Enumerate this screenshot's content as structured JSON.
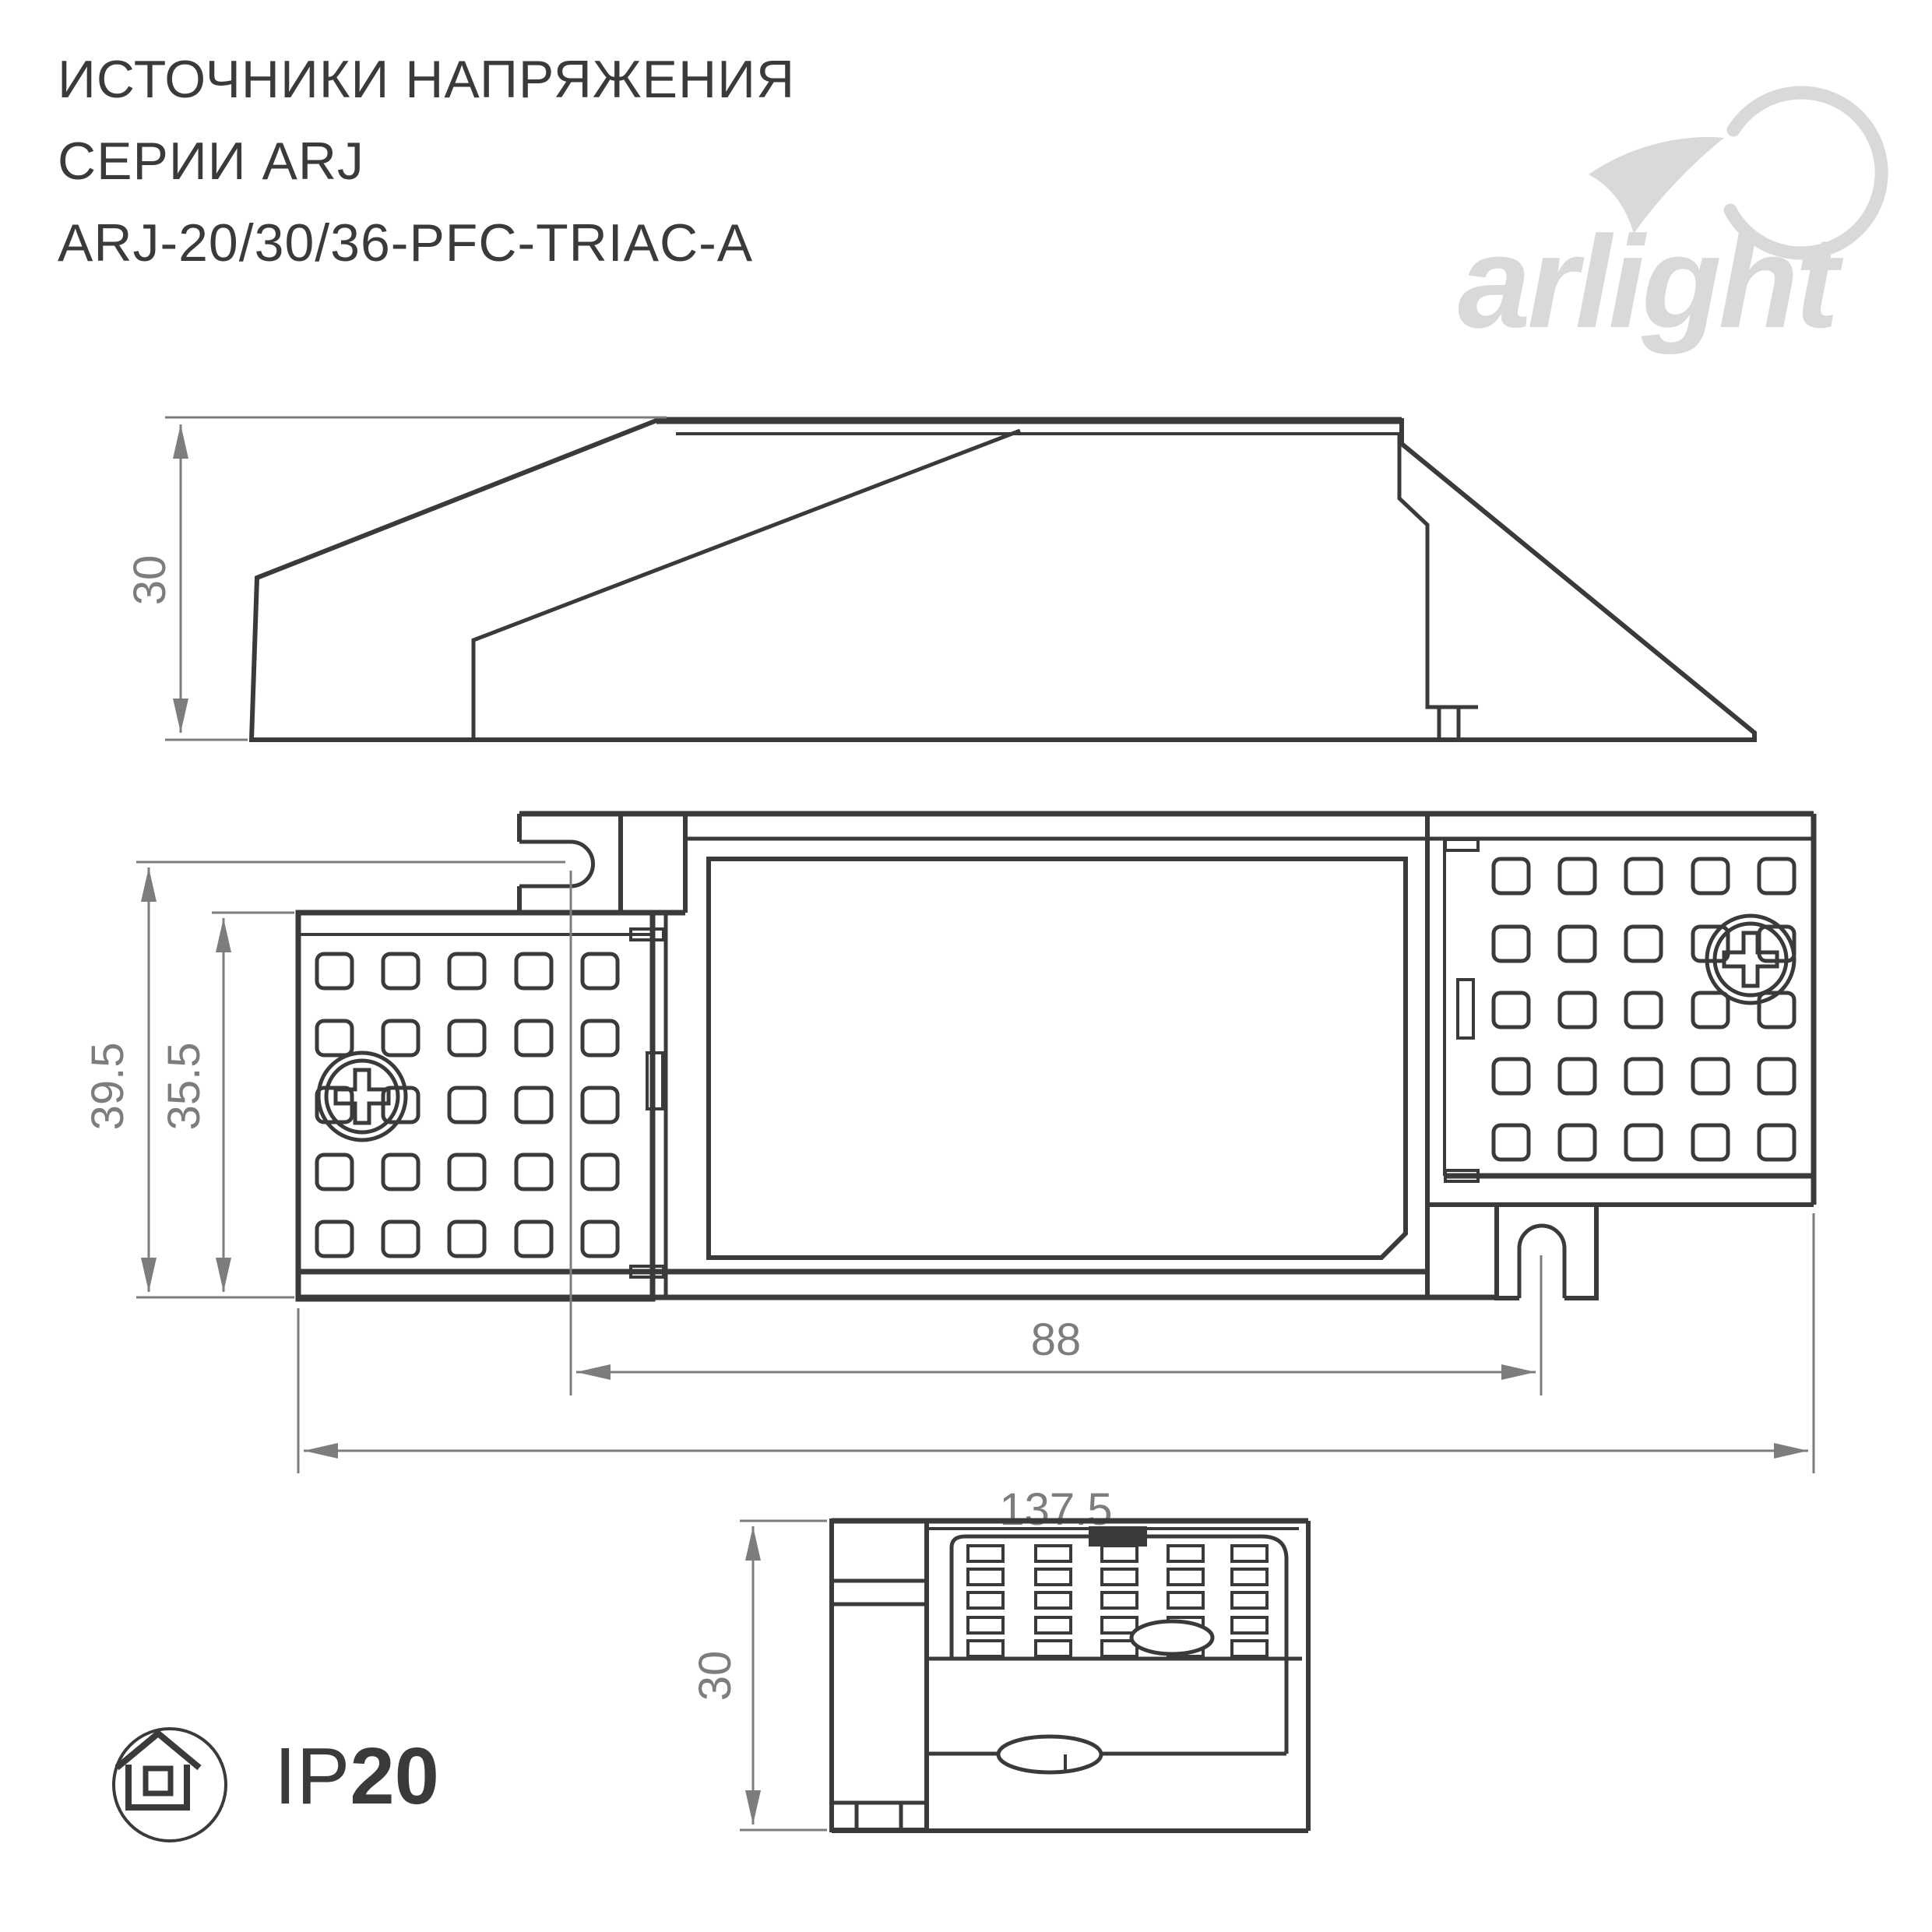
{
  "header": {
    "title_line1": "ИСТОЧНИКИ НАПРЯЖЕНИЯ",
    "title_line2": "СЕРИИ ARJ",
    "title_line3": "ARJ-20/30/36-PFC-TRIAC-A"
  },
  "logo": {
    "text": "arlight"
  },
  "views": {
    "side": {
      "dim_height": "30"
    },
    "plan": {
      "dim_overall_height": "39.5",
      "dim_inner_height": "35.5",
      "dim_hole_spacing": "88",
      "dim_overall_width": "137.5"
    },
    "end": {
      "dim_height": "30"
    }
  },
  "badge": {
    "ip_prefix": "IP",
    "ip_value": "20"
  },
  "colors": {
    "line": "#3a3a3a",
    "dim": "#7d7d7d",
    "logo": "#d9d9d9"
  }
}
